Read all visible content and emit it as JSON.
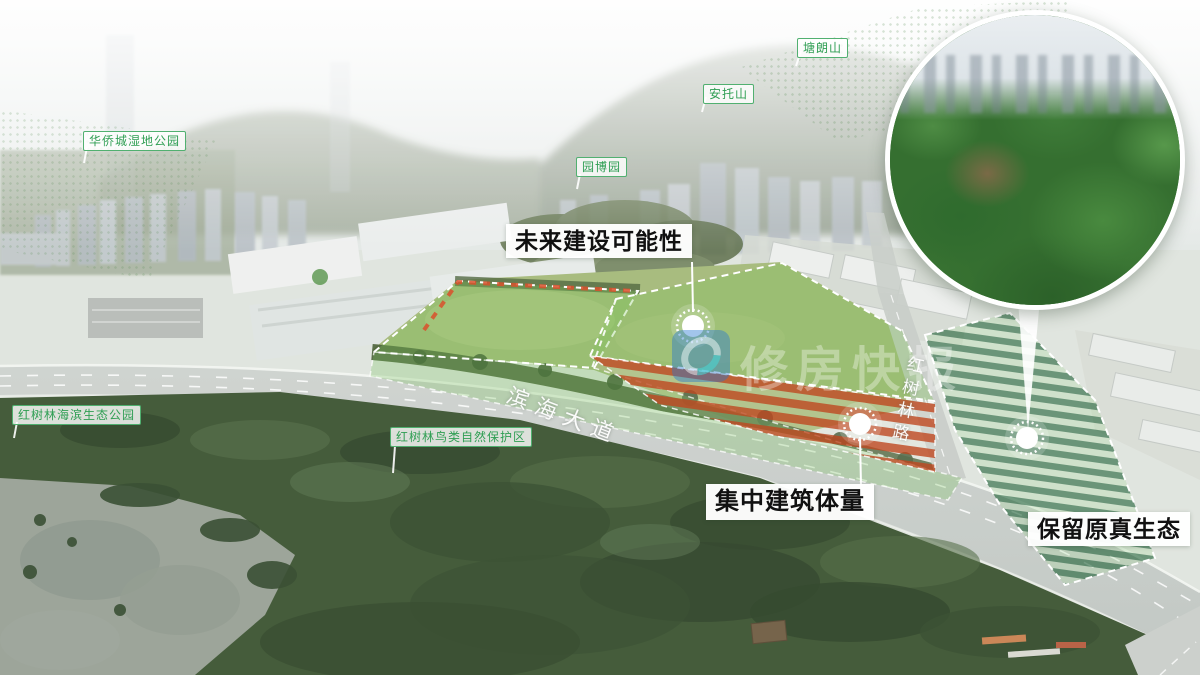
{
  "location_tags": [
    {
      "id": "oct-wetland-park",
      "label": "华侨城湿地公园"
    },
    {
      "id": "yuanbo-park",
      "label": "园博园"
    },
    {
      "id": "antuo-mountain",
      "label": "安托山"
    },
    {
      "id": "tanglang-mountain",
      "label": "塘朗山"
    },
    {
      "id": "mangrove-seaside-eco-park",
      "label": "红树林海滨生态公园"
    },
    {
      "id": "mangrove-bird-reserve",
      "label": "红树林鸟类自然保护区"
    }
  ],
  "callouts": [
    {
      "id": "future-construction",
      "label": "未来建设可能性"
    },
    {
      "id": "concentrated-building-mass",
      "label": "集中建筑体量"
    },
    {
      "id": "preserved-ecology",
      "label": "保留原真生态"
    }
  ],
  "roads": [
    {
      "id": "binhai-avenue",
      "label": "滨海大道"
    },
    {
      "id": "hongshulin-road",
      "label": "红树林路"
    }
  ],
  "watermark": {
    "text": "修房快报"
  },
  "colors": {
    "tag_green": "#2f9e53",
    "callout_text": "#111111",
    "zone_overlay_green": "#7dc35a",
    "zone_red_stripe": "#c14d26",
    "zone_dark_green_stripe": "#175c2e",
    "dashed_border": "#ffffff"
  }
}
